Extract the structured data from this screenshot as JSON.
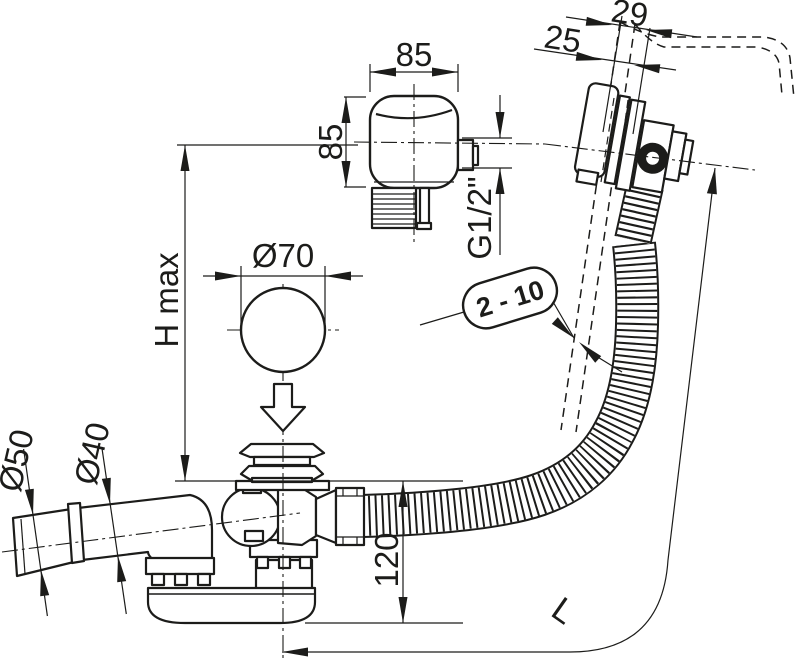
{
  "drawing": {
    "background": "#ffffff",
    "ink": "#1c1c1a",
    "labels": {
      "knob_width": "85",
      "knob_depth": "85",
      "overflow_offset_outer": "29",
      "overflow_offset_inner": "25",
      "overflow_thread": "G1/2\"",
      "wall_thickness_range": "2 - 10",
      "plug_diameter": "Ø70",
      "installation_height": "H max",
      "outlet_sleeve_diameter": "Ø50",
      "outlet_pipe_diameter": "Ø40",
      "trap_height": "120",
      "hose_length": "L"
    }
  }
}
